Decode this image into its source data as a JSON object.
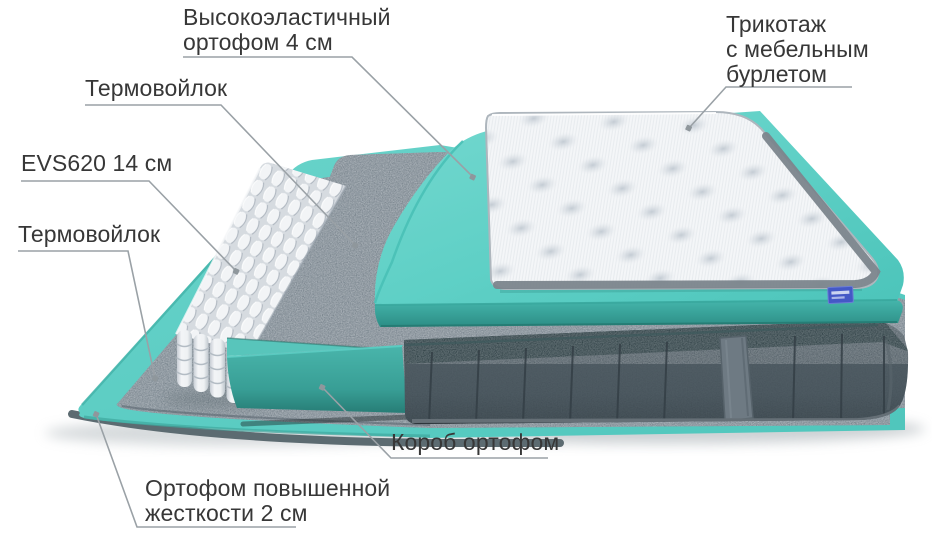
{
  "diagram": {
    "labels": {
      "top_foam": {
        "lines": [
          "Высокоэластичный",
          "ортофом 4 см"
        ]
      },
      "knit_cover": {
        "lines": [
          "Трикотаж",
          "с мебельным",
          "бурлетом"
        ]
      },
      "felt_upper": {
        "lines": [
          "Термовойлок"
        ]
      },
      "springs": {
        "lines": [
          "EVS620 14 см"
        ]
      },
      "felt_lower": {
        "lines": [
          "Термовойлок"
        ]
      },
      "box_foam": {
        "lines": [
          "Короб ортофом"
        ]
      },
      "base_foam": {
        "lines": [
          "Ортофом повышенной",
          "жесткости 2 см"
        ]
      }
    },
    "colors": {
      "foam_teal_light": "#5fd0c6",
      "foam_teal_dark": "#2f968d",
      "felt_gray": "#76828d",
      "base_fabric_gray": "#46525a",
      "base_top_dark": "#2a3c41",
      "cover_white": "#f4f6f8",
      "binding_gray": "#7b858c",
      "label_text": "#373737",
      "leader_line": "#9aa1a6",
      "brand_tag_blue": "#4458c6"
    }
  }
}
